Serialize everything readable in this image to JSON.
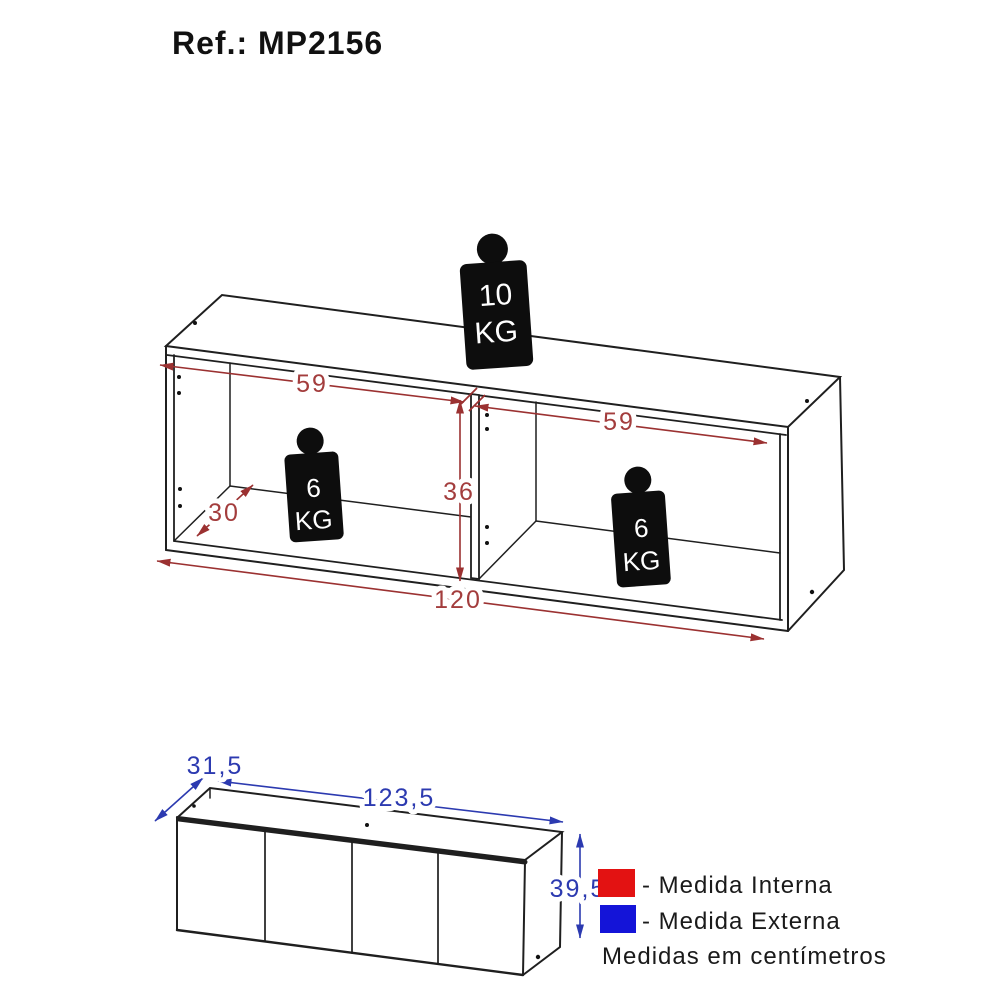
{
  "title": "Ref.: MP2156",
  "top_view": {
    "description": "open cabinet wireframe with internal measurements",
    "max_load_top": {
      "value": "10",
      "unit": "KG"
    },
    "max_load_left": {
      "value": "6",
      "unit": "KG"
    },
    "max_load_right": {
      "value": "6",
      "unit": "KG"
    },
    "dims": {
      "inner_width_left": "59",
      "inner_width_right": "59",
      "inner_height": "36",
      "inner_depth": "30",
      "total_width": "120"
    }
  },
  "bottom_view": {
    "description": "closed cabinet with external measurements",
    "dims": {
      "depth": "31,5",
      "width": "123,5",
      "height": "39,5"
    }
  },
  "legend": {
    "internal": {
      "label": "- Medida Interna",
      "color": "#e31212"
    },
    "external": {
      "label": "- Medida Externa",
      "color": "#1414d8"
    },
    "note": "Medidas em centímetros"
  },
  "colors": {
    "dim_internal_line": "#9b3131",
    "dim_external_line": "#2c3ab0",
    "drawing_line": "#1f1f1f"
  }
}
